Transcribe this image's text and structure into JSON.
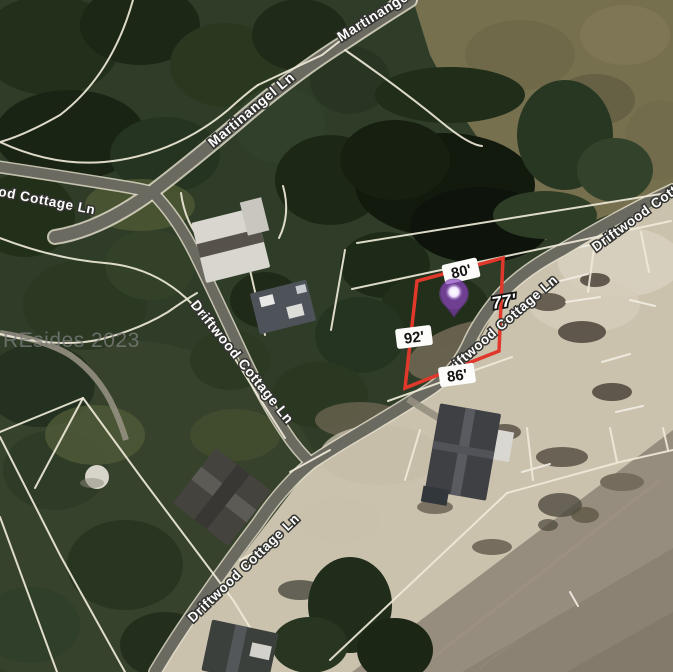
{
  "map": {
    "watermark": "REsides 2023",
    "streets": {
      "martinangel": "Martinangel Ln",
      "driftwood": "Driftwood Cottage Ln"
    },
    "parcel": {
      "side_top": "80'",
      "side_right": "77'",
      "side_left": "92'",
      "side_bottom": "86'",
      "outline_color": "#e0392c"
    },
    "marker": {
      "icon": "map-pin-icon",
      "color": "#8a3fc0"
    }
  }
}
